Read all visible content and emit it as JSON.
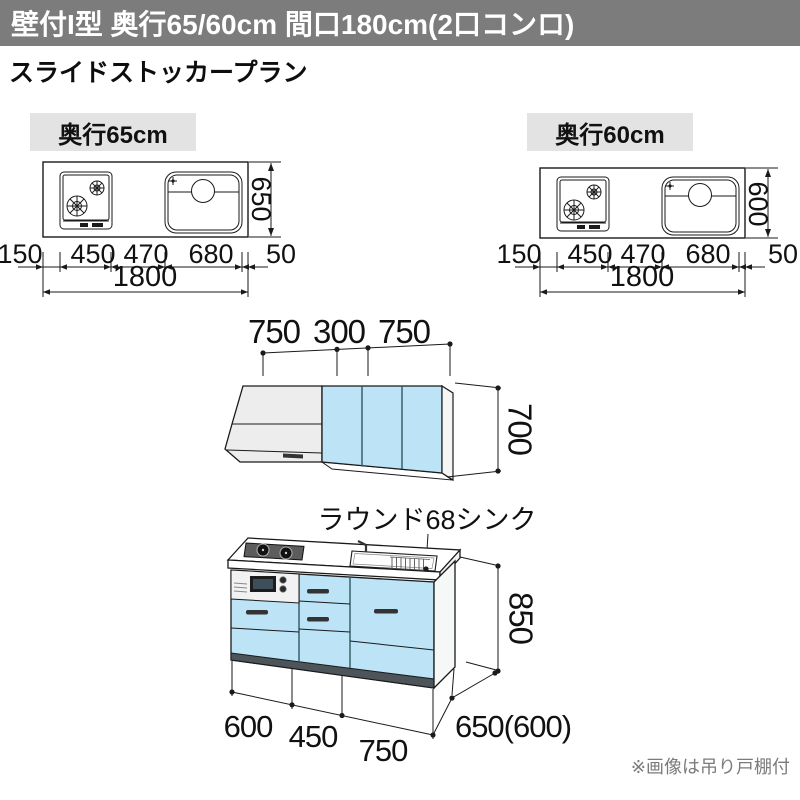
{
  "header": {
    "title": "壁付I型 奥行65/60cm 間口180cm(2口コンロ)"
  },
  "subtitle": "スライドストッカープラン",
  "plan_views": {
    "left": {
      "label": "奥行65cm",
      "depth_dim": "650",
      "width_dims": [
        "150",
        "450",
        "470",
        "680",
        "50"
      ],
      "total_dim": "1800"
    },
    "right": {
      "label": "奥行60cm",
      "depth_dim": "600",
      "width_dims": [
        "150",
        "450",
        "470",
        "680",
        "50"
      ],
      "total_dim": "1800"
    }
  },
  "wall_cabinet": {
    "width_dims": [
      "750",
      "300",
      "750"
    ],
    "height_dim": "700"
  },
  "base_cabinet": {
    "sink_label": "ラウンド68シンク",
    "height_dim": "850",
    "width_dims": [
      "600",
      "450",
      "750"
    ],
    "depth_dim": "650(600)"
  },
  "footnote": "※画像は吊り戸棚付",
  "colors": {
    "header_gray": "#7c7c7c",
    "chip_gray": "#e3e3e3",
    "cabinet_blue": "#bde3f6",
    "hood_gray": "#ededed"
  }
}
